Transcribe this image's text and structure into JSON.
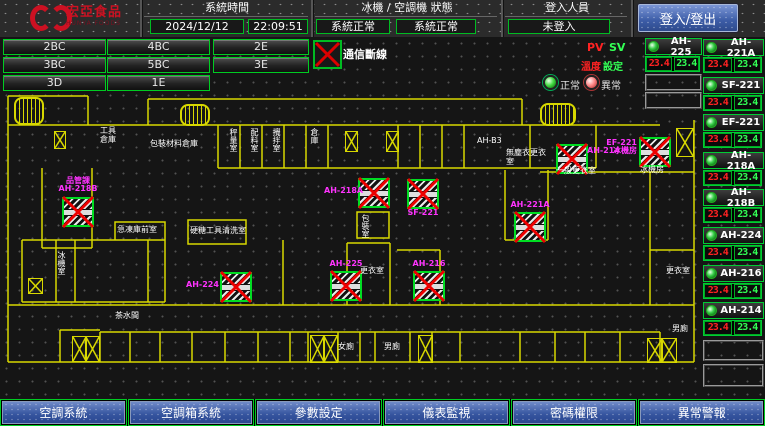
{
  "header": {
    "logo_title": "宏亞食品",
    "logo_subtitle": "HUNYA FOODS",
    "system_time_label": "系統時間",
    "date_value": "2024/12/12",
    "time_value": "22:09:51",
    "status_label": "冰機 / 空調機 狀態",
    "chiller_status": "系統正常",
    "ahu_status": "系統正常",
    "login_label": "登入人員",
    "login_status": "未登入",
    "login_button": "登入/登出"
  },
  "nav": {
    "buttons": [
      "2BC",
      "4BC",
      "2E",
      "3BC",
      "5BC",
      "3E",
      "3D",
      "1E"
    ]
  },
  "legend": {
    "comm_fail_label": "通信斷線",
    "normal_label": "正常",
    "abnormal_label": "異常",
    "pv_label": "PV",
    "sv_label": "SV",
    "temp_label": "溫度",
    "set_label": "設定"
  },
  "panel": {
    "col_a": [
      {
        "name": "AH-225",
        "pv": "23.4",
        "sv": "23.4"
      }
    ],
    "col_b": [
      {
        "name": "AH-221A",
        "pv": "23.4",
        "sv": "23.4"
      },
      {
        "name": "SF-221",
        "pv": "23.4",
        "sv": "23.4"
      },
      {
        "name": "EF-221",
        "pv": "23.4",
        "sv": "23.4"
      },
      {
        "name": "AH-218A",
        "pv": "23.4",
        "sv": "23.4"
      },
      {
        "name": "AH-218B",
        "pv": "23.4",
        "sv": "23.4"
      },
      {
        "name": "AH-224",
        "pv": "23.4",
        "sv": "23.4"
      },
      {
        "name": "AH-216",
        "pv": "23.4",
        "sv": "23.4"
      },
      {
        "name": "AH-214",
        "pv": "23.4",
        "sv": "23.4"
      }
    ]
  },
  "plan": {
    "units": [
      {
        "x": 62,
        "y": 160,
        "lines": [
          "品管課",
          "AH-218B"
        ],
        "lp": "above"
      },
      {
        "x": 220,
        "y": 235,
        "lines": [
          "AH-224"
        ],
        "lp": "left"
      },
      {
        "x": 330,
        "y": 234,
        "lines": [
          "AH-225"
        ],
        "lp": "above"
      },
      {
        "x": 413,
        "y": 234,
        "lines": [
          "AH-216"
        ],
        "lp": "above"
      },
      {
        "x": 358,
        "y": 141,
        "lines": [
          "AH-218A"
        ],
        "lp": "left"
      },
      {
        "x": 407,
        "y": 142,
        "lines": [
          "SF-221"
        ],
        "lp": "below"
      },
      {
        "x": 514,
        "y": 175,
        "lines": [
          "AH-221A"
        ],
        "lp": "above"
      },
      {
        "x": 556,
        "y": 107,
        "lines": [
          "AH-214"
        ],
        "lp": "right"
      },
      {
        "x": 639,
        "y": 100,
        "lines": [
          "EF-221",
          "冰機房"
        ],
        "lp": "left"
      }
    ],
    "rooms": [
      {
        "x": 100,
        "y": 89,
        "t": "工具倉庫",
        "w": 20
      },
      {
        "x": 150,
        "y": 102,
        "t": "包裝材料倉庫"
      },
      {
        "x": 229,
        "y": 91,
        "t": "秤量室",
        "v": true
      },
      {
        "x": 250,
        "y": 91,
        "t": "配料室",
        "v": true
      },
      {
        "x": 272,
        "y": 91,
        "t": "攪拌室",
        "v": true
      },
      {
        "x": 310,
        "y": 91,
        "t": "倉庫",
        "v": true
      },
      {
        "x": 477,
        "y": 99,
        "t": "AH-B3"
      },
      {
        "x": 506,
        "y": 111,
        "t": "無塵衣更衣室",
        "w": 46
      },
      {
        "x": 556,
        "y": 129,
        "t": "一般更衣室"
      },
      {
        "x": 640,
        "y": 128,
        "t": "冰機房"
      },
      {
        "x": 117,
        "y": 188,
        "t": "急凍庫前室"
      },
      {
        "x": 190,
        "y": 189,
        "t": "硬糖工具清洗室",
        "w": 56
      },
      {
        "x": 360,
        "y": 229,
        "t": "更衣室"
      },
      {
        "x": 361,
        "y": 177,
        "t": "包裝室",
        "v": true
      },
      {
        "x": 57,
        "y": 214,
        "t": "冰機室",
        "v": true
      },
      {
        "x": 115,
        "y": 274,
        "t": "茶水間"
      },
      {
        "x": 338,
        "y": 305,
        "t": "女廁"
      },
      {
        "x": 384,
        "y": 305,
        "t": "男廁"
      },
      {
        "x": 666,
        "y": 229,
        "t": "更衣室"
      },
      {
        "x": 672,
        "y": 287,
        "t": "男廁"
      }
    ],
    "xboxes": [
      {
        "x": 54,
        "y": 94,
        "w": 10,
        "h": 16
      },
      {
        "x": 345,
        "y": 94,
        "w": 11,
        "h": 19
      },
      {
        "x": 386,
        "y": 94,
        "w": 11,
        "h": 19
      },
      {
        "x": 676,
        "y": 91,
        "w": 16,
        "h": 27
      },
      {
        "x": 28,
        "y": 241,
        "w": 13,
        "h": 14
      },
      {
        "x": 72,
        "y": 299,
        "w": 13,
        "h": 24
      },
      {
        "x": 85,
        "y": 299,
        "w": 13,
        "h": 24
      },
      {
        "x": 310,
        "y": 298,
        "w": 13,
        "h": 26
      },
      {
        "x": 323,
        "y": 298,
        "w": 13,
        "h": 26
      },
      {
        "x": 418,
        "y": 298,
        "w": 13,
        "h": 26
      },
      {
        "x": 647,
        "y": 301,
        "w": 14,
        "h": 23
      },
      {
        "x": 661,
        "y": 301,
        "w": 14,
        "h": 23
      }
    ],
    "stairs": [
      {
        "x": 14,
        "y": 60,
        "w": 26,
        "h": 24
      },
      {
        "x": 180,
        "y": 67,
        "w": 26,
        "h": 18
      },
      {
        "x": 540,
        "y": 66,
        "w": 32,
        "h": 19
      }
    ]
  },
  "toolbar": {
    "buttons": [
      "空調系統",
      "空調箱系統",
      "參數設定",
      "儀表監視",
      "密碼權限",
      "異常警報"
    ]
  },
  "colors": {
    "accent_green": "#00cc22",
    "wall_yellow": "#d8d800",
    "ahu_magenta": "#ff33ff",
    "pv_red": "#ff2222",
    "sv_green": "#33ff55",
    "button_blue": "#3c5ca6",
    "logo_red": "#cc1122"
  }
}
